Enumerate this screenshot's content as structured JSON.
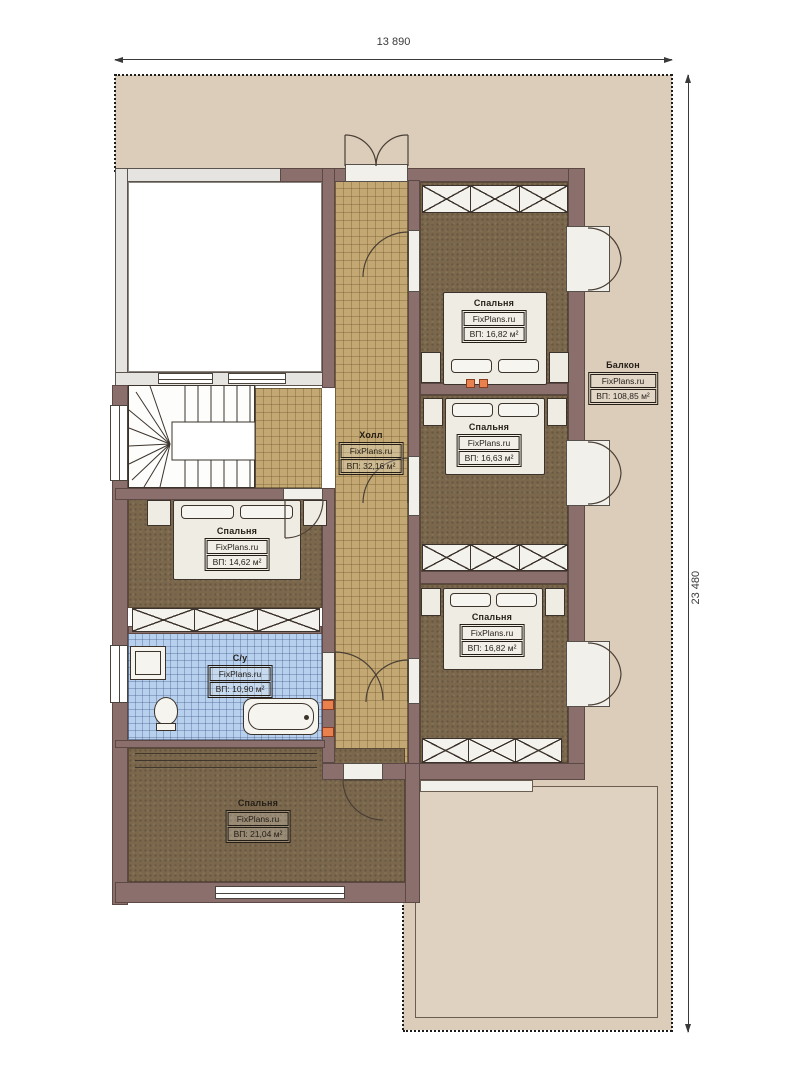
{
  "plan": {
    "title": "floor-plan",
    "brand": "FixPlans.ru",
    "dimensions": {
      "width_label": "13 890",
      "height_label": "23 480"
    },
    "rooms": {
      "bedroom_top_right": {
        "name": "Спальня",
        "area": "ВП: 16,82 м²"
      },
      "bedroom_mid_right": {
        "name": "Спальня",
        "area": "ВП: 16,63 м²"
      },
      "bedroom_bottom_right": {
        "name": "Спальня",
        "area": "ВП: 16,82 м²"
      },
      "bedroom_left": {
        "name": "Спальня",
        "area": "ВП: 14,62 м²"
      },
      "bedroom_bottom": {
        "name": "Спальня",
        "area": "ВП: 21,04 м²"
      },
      "hall": {
        "name": "Холл",
        "area": "ВП: 32,16 м²"
      },
      "bathroom": {
        "name": "С/у",
        "area": "ВП: 10,90 м²"
      },
      "balcony": {
        "name": "Балкон",
        "area": "ВП: 108,85 м²"
      }
    },
    "colors": {
      "site": "#dccdbb",
      "wall": "#8a6f6d",
      "carpet": "#7b684c",
      "hall_tile": "#c3a873",
      "bath_tile": "#b7d0ee",
      "outlet": "#e8814e"
    }
  }
}
